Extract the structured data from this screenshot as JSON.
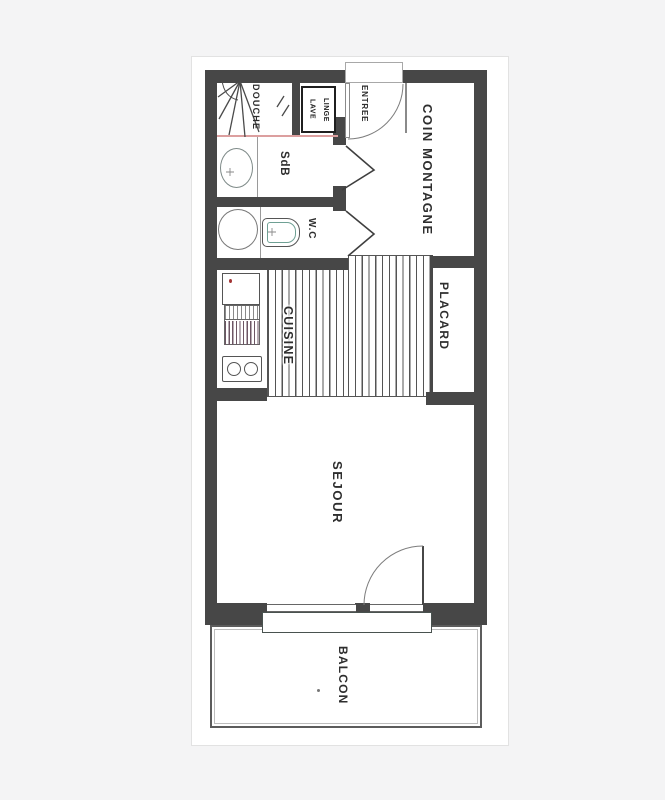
{
  "document": {
    "type": "apartment floor plan (scanned drawing)",
    "sheet_background": "#ffffff",
    "page_background": "#f4f4f5"
  },
  "plan": {
    "labels": {
      "douche": "DOUCHE",
      "lave_linge": "LAVE\nLINGE",
      "entree": "ENTREE",
      "coin_montagne": "COIN MONTAGNE",
      "sdb": "SdB",
      "wc": "W.C",
      "cuisine": "CUISINE",
      "placard": "PLACARD",
      "sejour": "SEJOUR",
      "balcon": "BALCON"
    },
    "colors": {
      "wall": "#474747",
      "thin_line": "#8a8a8a",
      "pink_line": "#dc9f9f",
      "teal_line": "#6fa094",
      "text": "#2e2e2e",
      "red_dot": "#a23333"
    },
    "fixtures": [
      "shower-fan",
      "washing-machine",
      "washbasin-oval",
      "round-basin",
      "toilet",
      "kitchen-counter",
      "sink-drainer",
      "stove-two-burners",
      "entry-door-arc",
      "bathroom-door-wedge",
      "wc-door-wedge",
      "balcony-door-arc",
      "window-sill",
      "hatched-floor"
    ]
  }
}
